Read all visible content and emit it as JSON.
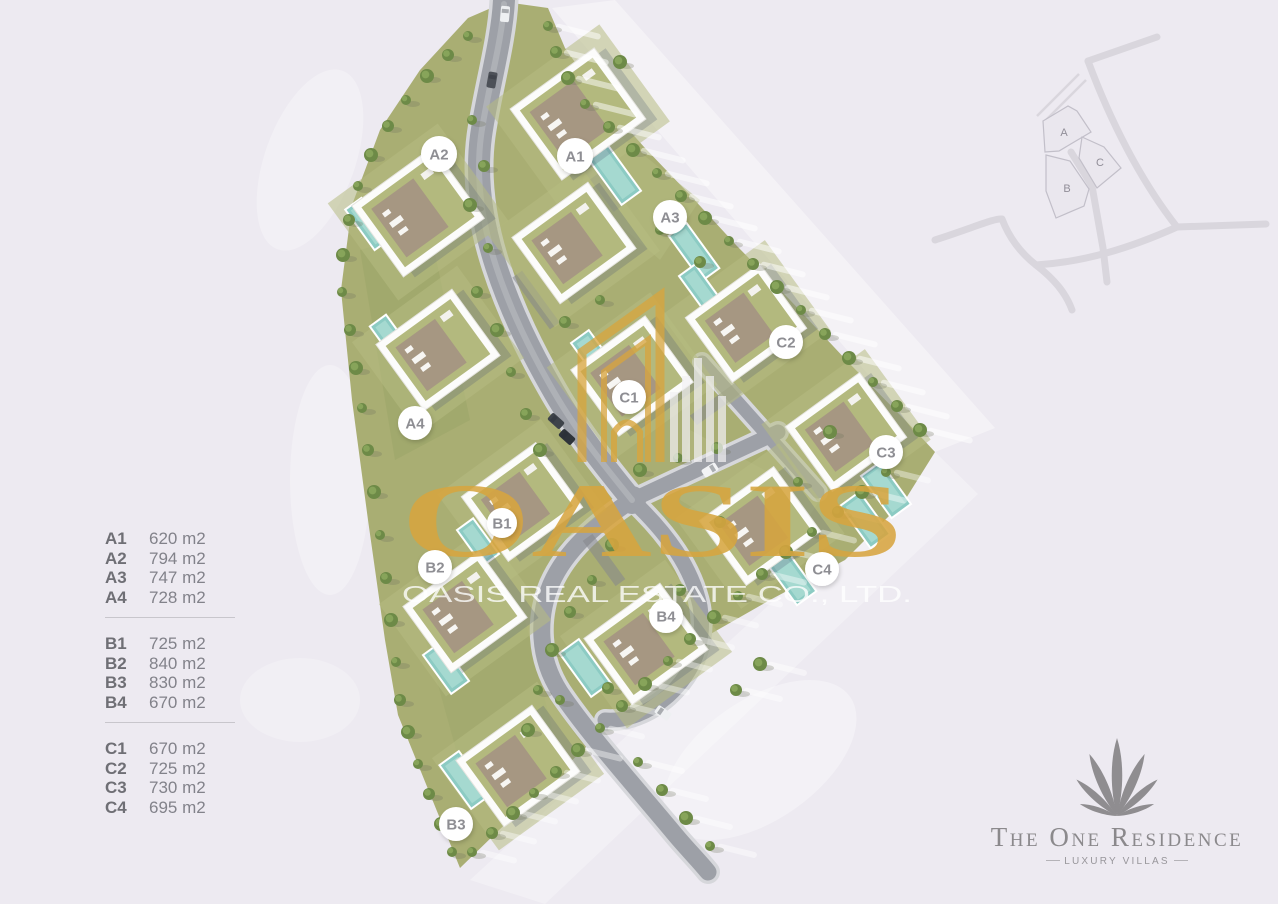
{
  "page": {
    "background": "#edeaf1"
  },
  "legend": {
    "groups": [
      {
        "name": "A",
        "rows": [
          {
            "id": "A1",
            "area": "620 m2"
          },
          {
            "id": "A2",
            "area": "794 m2"
          },
          {
            "id": "A3",
            "area": "747 m2"
          },
          {
            "id": "A4",
            "area": "728 m2"
          }
        ]
      },
      {
        "name": "B",
        "rows": [
          {
            "id": "B1",
            "area": "725 m2"
          },
          {
            "id": "B2",
            "area": "840 m2"
          },
          {
            "id": "B3",
            "area": "830 m2"
          },
          {
            "id": "B4",
            "area": "670 m2"
          }
        ]
      },
      {
        "name": "C",
        "rows": [
          {
            "id": "C1",
            "area": "670 m2"
          },
          {
            "id": "C2",
            "area": "725 m2"
          },
          {
            "id": "C3",
            "area": "730 m2"
          },
          {
            "id": "C4",
            "area": "695 m2"
          }
        ]
      }
    ]
  },
  "site_plan": {
    "plot_badges": [
      {
        "id": "A1",
        "x": 575,
        "y": 156,
        "r": 18
      },
      {
        "id": "A2",
        "x": 439,
        "y": 154,
        "r": 18
      },
      {
        "id": "A3",
        "x": 670,
        "y": 217,
        "r": 17
      },
      {
        "id": "A4",
        "x": 415,
        "y": 423,
        "r": 17
      },
      {
        "id": "B1",
        "x": 502,
        "y": 523,
        "r": 15
      },
      {
        "id": "B2",
        "x": 435,
        "y": 567,
        "r": 17
      },
      {
        "id": "B3",
        "x": 456,
        "y": 824,
        "r": 17
      },
      {
        "id": "B4",
        "x": 666,
        "y": 616,
        "r": 17
      },
      {
        "id": "C1",
        "x": 629,
        "y": 397,
        "r": 17
      },
      {
        "id": "C2",
        "x": 786,
        "y": 342,
        "r": 17
      },
      {
        "id": "C3",
        "x": 886,
        "y": 452,
        "r": 17
      },
      {
        "id": "C4",
        "x": 822,
        "y": 569,
        "r": 17
      }
    ]
  },
  "watermark": {
    "brand": "OASIS",
    "company": "OASIS REAL ESTATE CO., LTD.",
    "gold": "#D7A53E"
  },
  "minimap": {
    "zones": [
      {
        "label": "A"
      },
      {
        "label": "C"
      },
      {
        "label": "B"
      }
    ]
  },
  "logo": {
    "title": "The One Residence",
    "subtitle": "LUXURY VILLAS"
  },
  "colors": {
    "background": "#edeaf1",
    "grass": "#a9ae73",
    "road": "#9da0a7",
    "pool": "#8ccbc3",
    "gold": "#D7A53E",
    "badge_text": "#8e8e93",
    "legend_label": "#6f6f75",
    "legend_value": "#82828a",
    "logo_gray": "#8b898c",
    "minimap_line": "#d9d6dd"
  }
}
